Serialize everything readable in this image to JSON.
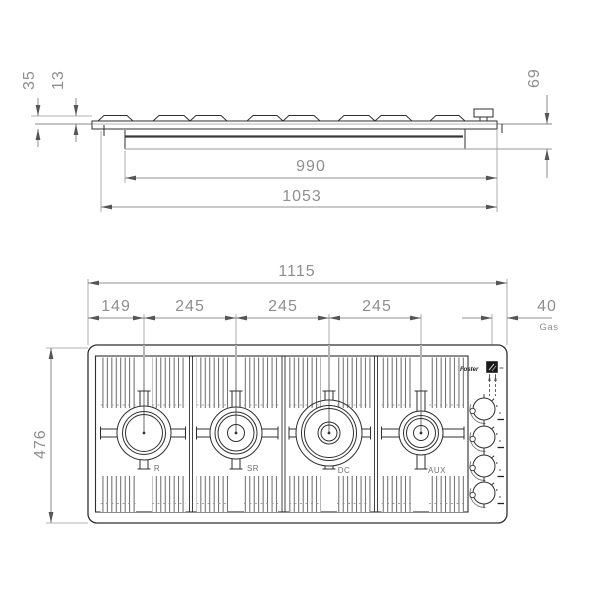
{
  "side_view": {
    "dims": {
      "shallow_depth": "35",
      "lip_height": "13",
      "total_depth": "69",
      "body_width": "990",
      "overall_width": "1053"
    }
  },
  "plan_view": {
    "dims": {
      "overall_width": "1115",
      "first_burner_offset": "149",
      "burner_pitch_1": "245",
      "burner_pitch_2": "245",
      "burner_pitch_3": "245",
      "gas_connection_offset": "40",
      "overall_depth": "476"
    },
    "gas_label": "Gas",
    "brand": "Foster",
    "burners": [
      {
        "label": "R"
      },
      {
        "label": "SR"
      },
      {
        "label": "DC"
      },
      {
        "label": "AUX"
      }
    ],
    "knob_count": 4
  },
  "colors": {
    "line": "#2f2f2f",
    "dim_line": "#6e6e6e",
    "dim_text": "#8f8f8f",
    "background": "#ffffff"
  }
}
